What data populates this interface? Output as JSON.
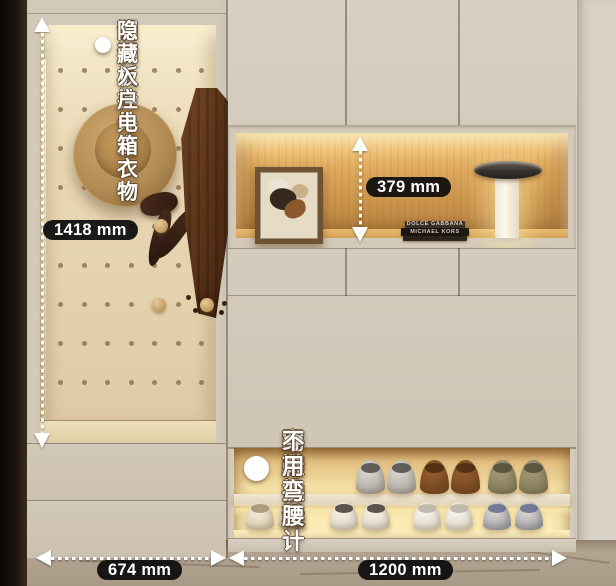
{
  "annotations": {
    "top_note": {
      "line1": "洞洞板挂外出衣物",
      "line2": "隐藏入户电箱"
    },
    "bottom_note": {
      "line1": "踢脚抽设计",
      "line2": "穿鞋换鞋",
      "line3": "不用弯腰"
    }
  },
  "dimensions": {
    "cabinet_height": "1418 mm",
    "niche_height": "379 mm",
    "left_width": "674 mm",
    "right_width": "1200 mm"
  },
  "books": {
    "top_spine": "DOLCE GABBANA",
    "bottom_spine": "MICHAEL KORS"
  },
  "scene": {
    "description": "Beige entryway cabinet: pegboard coat niche with straw hat and brown coat, lit display niche with artwork, books and lamp, toe-kick shoe drawer with two lit shelves of shoes",
    "colors": {
      "wall": "#d7d0c3",
      "cabinet": "#d3cabb",
      "niche_wood": "#cf9c52",
      "warm_glow": "#ffeeb8",
      "floor": "#b3a493",
      "dark_edge": "#16100a",
      "dimension_pill_bg": "#0c0c0c",
      "annotation_text": "#ffffff"
    },
    "pegboard": {
      "cols": 7,
      "rows": 9,
      "x0": 18,
      "y0": 43,
      "dx": 23.5,
      "dy": 39,
      "hole": 5
    },
    "shoes": {
      "size_top": {
        "w": 29,
        "h": 34,
        "top": 12,
        "gap": 31
      },
      "size_bottom": {
        "w": 28,
        "h": 28,
        "top": 54,
        "gap": 32
      },
      "top_pairs": [
        {
          "x": 122,
          "c1": "#dcd8d3",
          "c2": "#a39e97",
          "open": "#4e4a45",
          "name": "silver-slippers"
        },
        {
          "x": 186,
          "c1": "#96602e",
          "c2": "#6a3d1a",
          "open": "#4a2a10",
          "name": "brown-slippers"
        },
        {
          "x": 254,
          "c1": "#a39b76",
          "c2": "#7b7454",
          "open": "#4f4b36",
          "name": "olive-slippers"
        }
      ],
      "bottom_pairs": [
        {
          "x": 12,
          "c1": "#f4ecd9",
          "c2": "#d6c7a9",
          "open": "#a18f6f",
          "name": "cream-slippers"
        },
        {
          "x": 96,
          "c1": "#f6f1e6",
          "c2": "#d9d1c0",
          "open": "#3f3a32",
          "name": "white-flats"
        },
        {
          "x": 179,
          "c1": "#f8f4ed",
          "c2": "#dcd5c8",
          "open": "#b9b2a4",
          "name": "white-sneakers"
        },
        {
          "x": 249,
          "c1": "#e3dccd",
          "c2": "#8a93ab",
          "open": "#5e6b8d",
          "name": "patterned-sneakers"
        }
      ]
    }
  }
}
